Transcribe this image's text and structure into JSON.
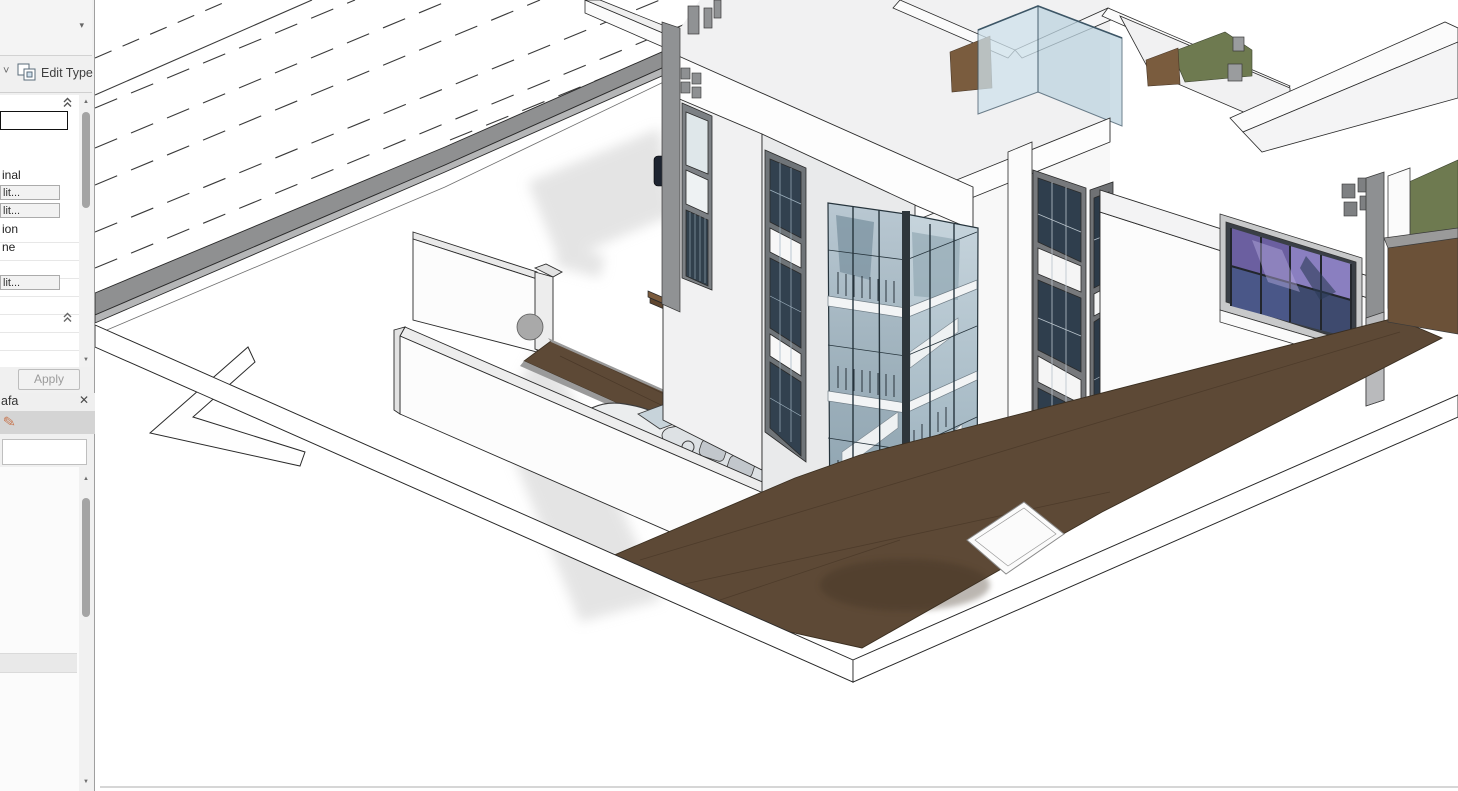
{
  "window": {
    "app": "Revit-style BIM editor, cropped view",
    "canvas_background": "#ffffff"
  },
  "properties_panel": {
    "type_selector": {
      "visible_value": ""
    },
    "edit_type": {
      "label": "Edit Type"
    },
    "grid": {
      "value_editor_text": "",
      "rows": [
        {
          "kind": "text",
          "value": "inal"
        },
        {
          "kind": "button",
          "value": "lit..."
        },
        {
          "kind": "button",
          "value": "lit..."
        },
        {
          "kind": "text",
          "value": "ion"
        },
        {
          "kind": "text",
          "value": "ne"
        },
        {
          "kind": "button",
          "value": "lit..."
        }
      ]
    },
    "apply": {
      "label": "Apply",
      "enabled": false
    }
  },
  "browser_panel": {
    "title_fragment": "afa",
    "search_value": "",
    "placeholder": ""
  },
  "icons": {
    "dropdown": "▾",
    "chevron_down": "˅",
    "close": "✕",
    "scroll_up": "▲",
    "scroll_down": "▼",
    "pin": "✎"
  },
  "scene": {
    "description": "Isometric 3D view of a modern two/three-storey white villa with corner glass stair tower, walled courtyard with convertible car, wood decks, roof terraces with grass and glass railing, and a road with dashed lane markings",
    "elements": [
      "road",
      "lane-markings",
      "median-curb",
      "sidewalk",
      "site-wall",
      "gate-arrow",
      "driveway",
      "convertible-car",
      "walkway-deck",
      "entrance-steps",
      "white-villa",
      "stair-glass-curtain-wall",
      "corner-window-strips",
      "picture-window-purple",
      "roof-terrace",
      "grass-patches",
      "wood-deck",
      "white-patio",
      "glass-roof-railing",
      "wall-lights",
      "shadows"
    ],
    "palette": {
      "outline": "#2a2a2a",
      "wall_white": "#fdfdfd",
      "wall_light": "#f1f1f2",
      "wall_mid": "#e9eaeb",
      "roof": "#f2f2f3",
      "road_gray": "#8f9091",
      "curb_light": "#b5b6b7",
      "glass_blue": "#aec1cc",
      "glass_dark": "#7e95a3",
      "railing_blue": "#cfe2ec",
      "mullion": "#26343c",
      "deck_brown": "#5d4936",
      "deck_dark": "#4a3828",
      "grass_green": "#6e7a50",
      "window_purple": "#7a6fae",
      "window_navy": "#3e4a6e",
      "shadow": "#d6d6d6",
      "car_body": "#ebedee"
    }
  }
}
